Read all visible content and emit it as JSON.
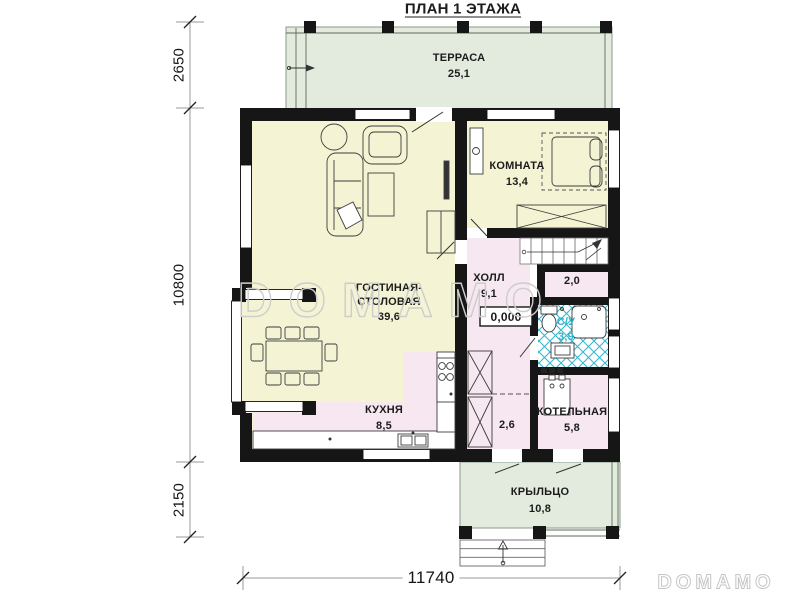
{
  "title": "ПЛАН 1 ЭТАЖА",
  "watermark": {
    "main": "DOMAMO",
    "corner": "DOMAMO"
  },
  "dimensions": {
    "terrace_depth": "2650",
    "house_depth": "10800",
    "porch_depth": "2150",
    "house_width": "11740"
  },
  "rooms": {
    "terrace": {
      "name": "ТЕРРАСА",
      "area": "25,1"
    },
    "living_dining": {
      "name_line1": "ГОСТИНАЯ-",
      "name_line2": "СТОЛОВАЯ",
      "area": "39,6"
    },
    "bedroom": {
      "name": "КОМНАТА",
      "area": "13,4"
    },
    "hall": {
      "name": "ХОЛЛ",
      "area": "9,1",
      "floor_level": "0,000"
    },
    "stair_storage": {
      "area": "2,0"
    },
    "bathroom": {
      "name": "С/У",
      "area": "3,9"
    },
    "kitchen": {
      "name": "КУХНЯ",
      "area": "8,5"
    },
    "entry": {
      "area": "2,6"
    },
    "boiler_room": {
      "name": "КОТЕЛЬНАЯ",
      "area": "5,8"
    },
    "porch": {
      "name": "КРЫЛЬЦО",
      "area": "10,8"
    }
  },
  "colors": {
    "living_fill": "#f4f4d5",
    "service_fill": "#f6e7f0",
    "outdoor_fill": "#e3ebdf",
    "tile_accent": "#35b8cf",
    "wall": "#161616"
  }
}
